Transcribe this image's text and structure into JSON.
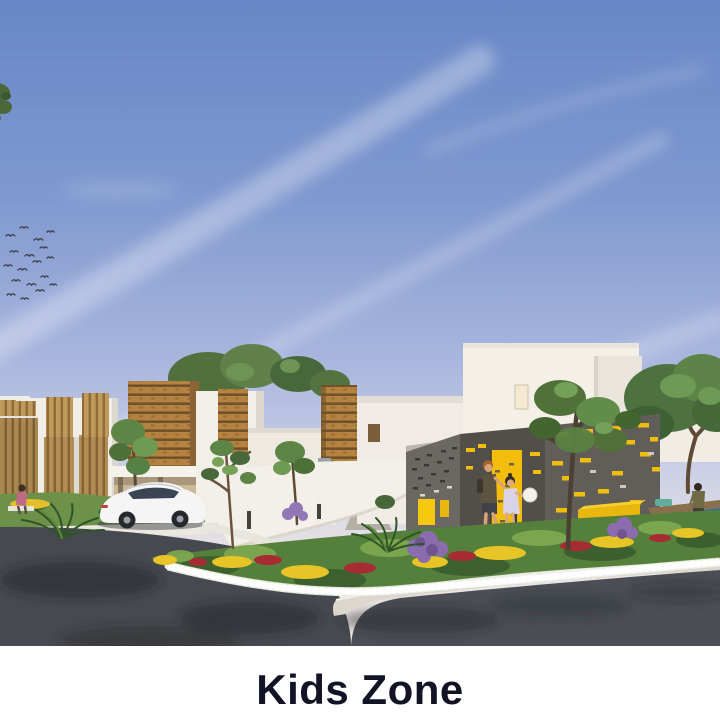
{
  "caption": {
    "text": "Kids Zone",
    "color": "#131326"
  },
  "image": {
    "alt": "3D architectural rendering of a residential community: white villas with wooden slat facades, a white sedan parked by a carport, a grey kids-zone pavilion with a yellow door and yellow window slots, two children at the entrance, a small pool with a seated person, flower beds with white, yellow, red and purple blooms, trees, a curving asphalt road and a blue sky with wispy clouds and a flock of birds"
  },
  "palette": {
    "background": "#ffffff",
    "sky_top": "#6887c6",
    "sky_horizon": "#f1ebe6",
    "wood_accent": "#b5823f",
    "pavilion_grey": "#615d58",
    "accent_yellow": "#f2bd0b",
    "foliage_green": "#55803c",
    "road_asphalt": "#46494f",
    "pool_blue": "#2e6f9e",
    "caption_color": "#131326"
  }
}
